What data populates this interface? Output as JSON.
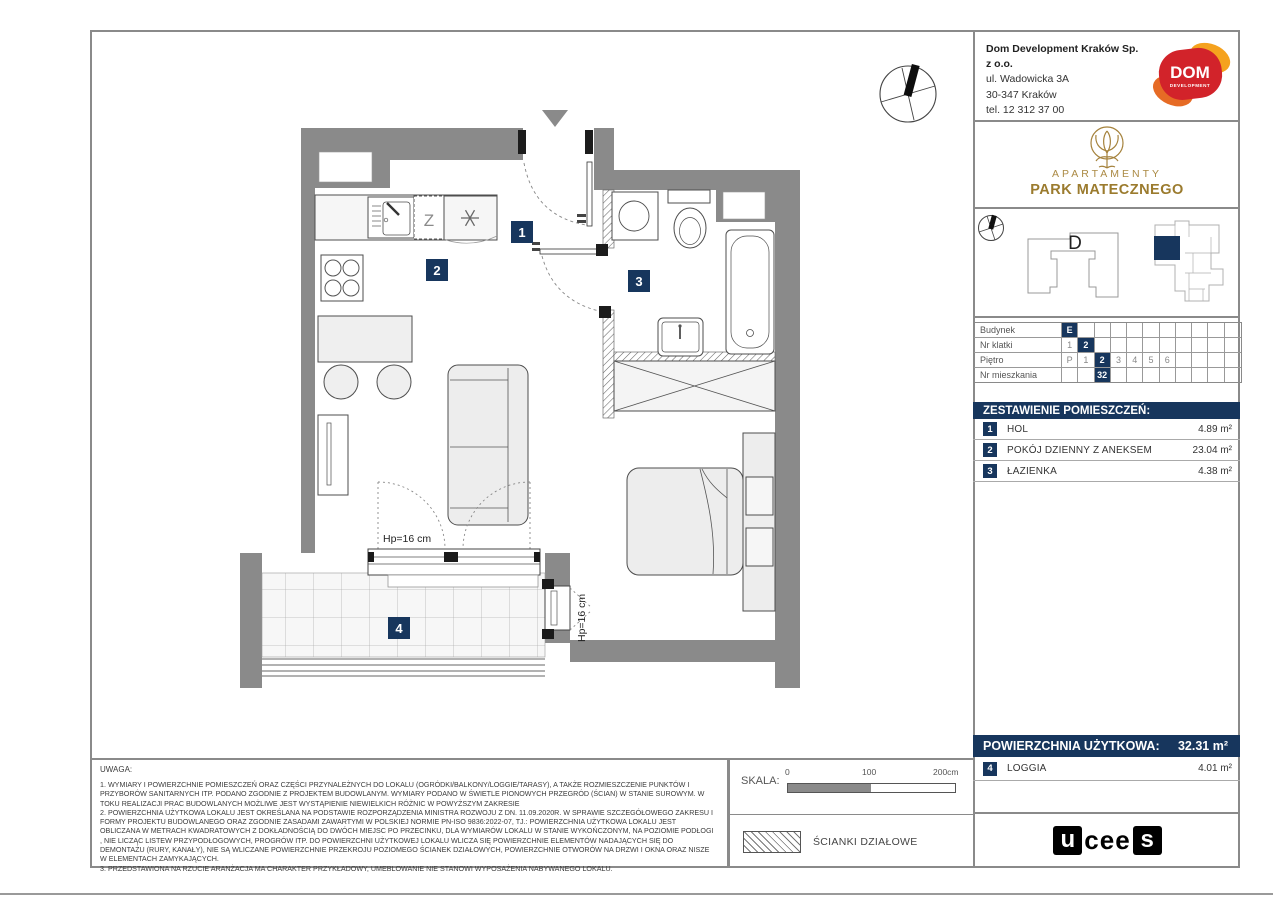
{
  "colors": {
    "navy": "#17365d",
    "wall": "#8a8a8a",
    "gold": "#a5823c",
    "dom_red": "#d2232a",
    "dom_orange": "#f09a1e"
  },
  "publisher": {
    "name": "Dom Development Kraków Sp. z o.o.",
    "address": "ul. Wadowicka 3A",
    "city": "30-347 Kraków",
    "phone": "tel. 12 312 37 00"
  },
  "dom_logo": {
    "text": "DOM",
    "subtext": "DEVELOPMENT"
  },
  "estate": {
    "line1": "APARTAMENTY",
    "line2": "PARK MATECZNEGO"
  },
  "location": {
    "building_label": "D"
  },
  "unit_table": {
    "num_cols": 11,
    "rows": [
      {
        "label": "Budynek",
        "cells": [
          {
            "t": "E",
            "hl": true
          }
        ]
      },
      {
        "label": "Nr klatki",
        "cells": [
          {
            "t": "1"
          },
          {
            "t": "2",
            "hl": true
          }
        ]
      },
      {
        "label": "Piętro",
        "cells": [
          {
            "t": "P"
          },
          {
            "t": "1"
          },
          {
            "t": "2",
            "hl": true
          },
          {
            "t": "3"
          },
          {
            "t": "4"
          },
          {
            "t": "5"
          },
          {
            "t": "6"
          }
        ]
      },
      {
        "label": "Nr mieszkania",
        "cells": [
          {
            "t": ""
          },
          {
            "t": ""
          },
          {
            "t": "32",
            "hl": true
          }
        ]
      }
    ]
  },
  "rooms": {
    "header": "ZESTAWIENIE POMIESZCZEŃ:",
    "items": [
      {
        "num": "1",
        "name": "HOL",
        "area": "4.89 m²"
      },
      {
        "num": "2",
        "name": "POKÓJ DZIENNY Z ANEKSEM",
        "area": "23.04 m²"
      },
      {
        "num": "3",
        "name": "ŁAZIENKA",
        "area": "4.38 m²"
      }
    ]
  },
  "summary": {
    "label": "POWIERZCHNIA UŻYTKOWA:",
    "value": "32.31 m²",
    "loggia": {
      "num": "4",
      "name": "LOGGIA",
      "area": "4.01 m²"
    }
  },
  "plan": {
    "room1": "1",
    "room2": "2",
    "room3": "3",
    "room4": "4",
    "hp_label": "Hp=16 cm",
    "hp_label2": "Hp=16 cm",
    "dishwasher_label": "Z"
  },
  "scalebar": {
    "label": "SKALA:",
    "tick0": "0",
    "tick1": "100",
    "tick2": "200cm"
  },
  "legend": {
    "partition": "ŚCIANKI DZIAŁOWE"
  },
  "notes": {
    "title": "UWAGA:",
    "paragraphs": [
      "1. WYMIARY I POWIERZCHNIE POMIESZCZEŃ ORAZ CZĘŚCI PRZYNALEŻNYCH DO LOKALU (OGRÓDKI/BALKONY/LOGGIE/TARASY), A TAKŻE ROZMIESZCZENIE PUNKTÓW I PRZYBORÓW SANITARNYCH ITP. PODANO ZGODNIE Z PROJEKTEM BUDOWLANYM. WYMIARY PODANO W ŚWIETLE PIONOWYCH PRZEGRÓD (ŚCIAN) W STANIE SUROWYM. W TOKU REALIZACJI PRAC BUDOWLANYCH MOŻLIWE JEST WYSTĄPIENIE NIEWIELKICH RÓŻNIC W POWYŻSZYM ZAKRESIE",
      "2. POWIERZCHNIA UŻYTKOWA LOKALU JEST OKREŚLANA NA PODSTAWIE ROZPORZĄDZENIA MINISTRA ROZWOJU Z DN. 11.09.2020R. W SPRAWIE SZCZEGÓŁOWEGO ZAKRESU I FORMY PROJEKTU BUDOWLANEGO ORAZ ZGODNIE ZASADAMI ZAWARTYMI W POLSKIEJ NORMIE PN-ISO 9836:2022-07, TJ.: POWIERZCHNIA UŻYTKOWA LOKALU JEST OBLICZANA W METRACH KWADRATOWYCH Z DOKŁADNOŚCIĄ DO DWÓCH MIEJSC PO PRZECINKU, DLA WYMIARÓW LOKALU W STANIE WYKOŃCZONYM, NA POZIOMIE PODŁOGI , NIE LICZĄC LISTEW PRZYPODŁOGOWYCH, PROGRÓW ITP. DO POWIERZCHNI UŻYTKOWEJ LOKALU WLICZA SIĘ POWIERZCHNIE ELEMENTÓW NADAJĄCYCH SIĘ DO DEMONTAŻU (RURY, KANAŁY), NIE SĄ WLICZANE POWIERZCHNIE PRZEKROJU POZIOMEGO ŚCIANEK DZIAŁOWYCH, POWIERZCHNIE OTWORÓW NA DRZWI I OKNA ORAZ NISZE W ELEMENTACH ZAMYKAJĄCYCH.",
      "3. PRZEDSTAWIONA NA RZUCIE ARANŻACJA MA CHARAKTER PRZYKŁADOWY, UMEBLOWANIE NIE STANOWI WYPOSAŻENIA NABYWANEGO LOKALU."
    ]
  },
  "footer_logo": {
    "l1": "u",
    "l2": "cee",
    "l3": "s"
  }
}
